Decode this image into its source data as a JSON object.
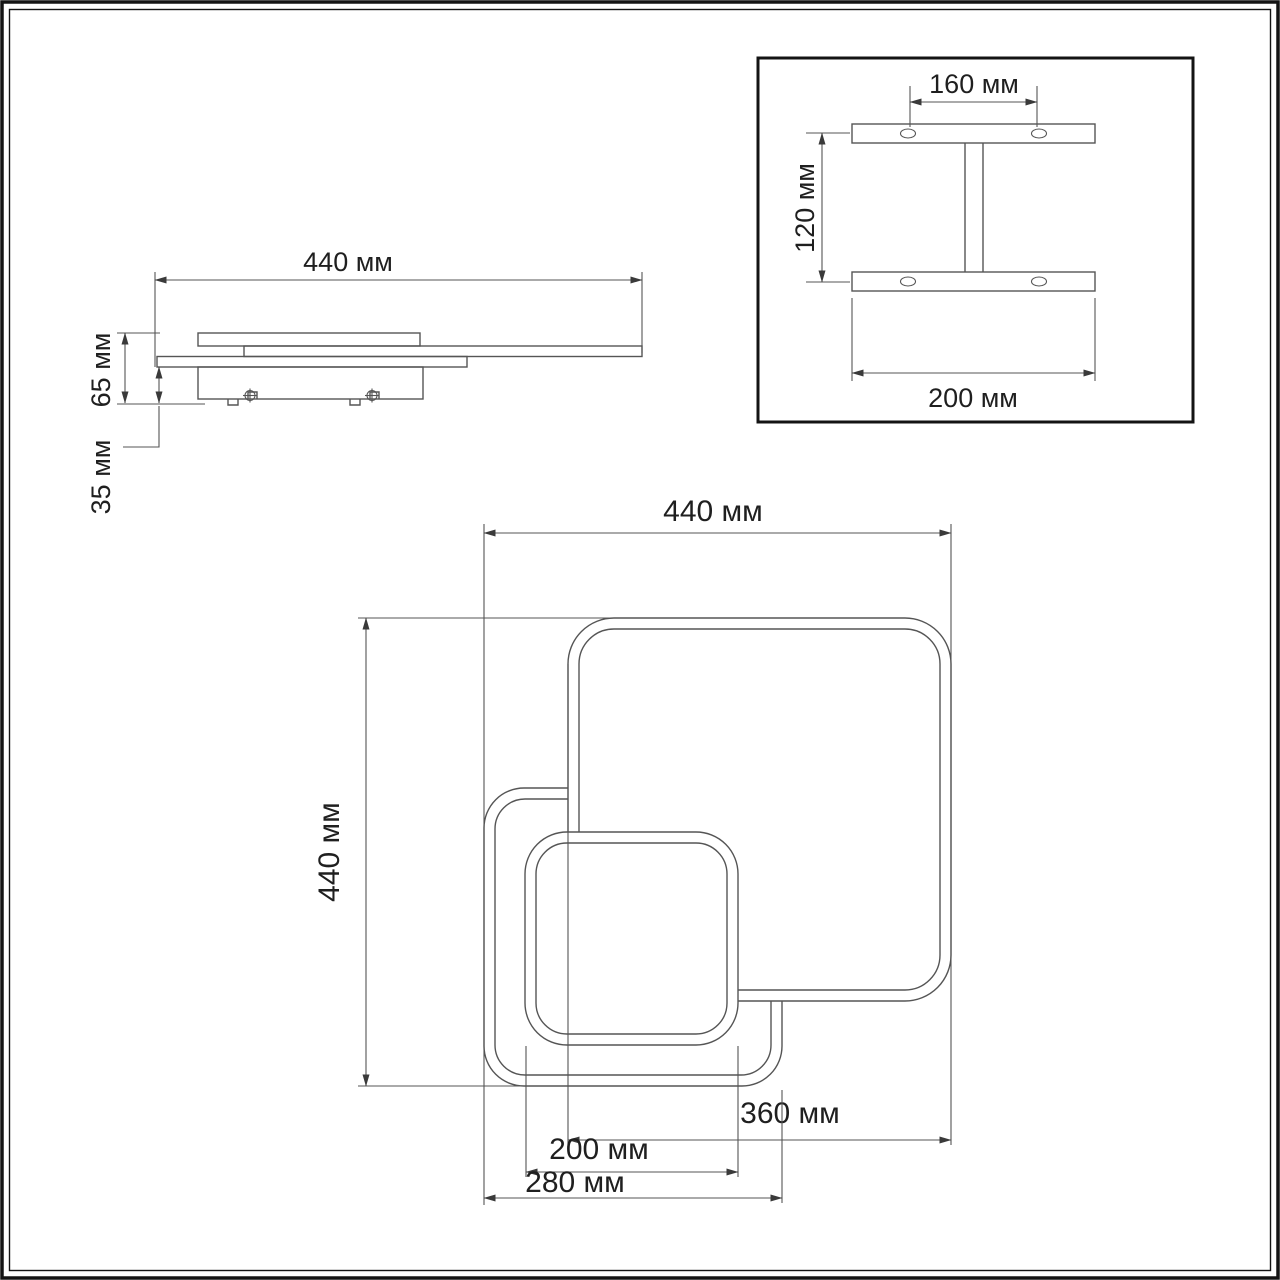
{
  "views": {
    "side": {
      "width": "440 мм",
      "height": "65 мм",
      "mount_height": "35 мм"
    },
    "bracket": {
      "hole_spacing": "160 мм",
      "bar_spacing": "120 мм",
      "bar_length": "200 мм"
    },
    "plan": {
      "width": "440 мм",
      "height": "440 мм",
      "large_square": "360 мм",
      "medium_square": "280 мм",
      "small_square": "200 мм"
    }
  },
  "colors": {
    "background": "#ffffff",
    "line": "#555555",
    "text": "#1f1f1f",
    "frame": "#141414"
  }
}
